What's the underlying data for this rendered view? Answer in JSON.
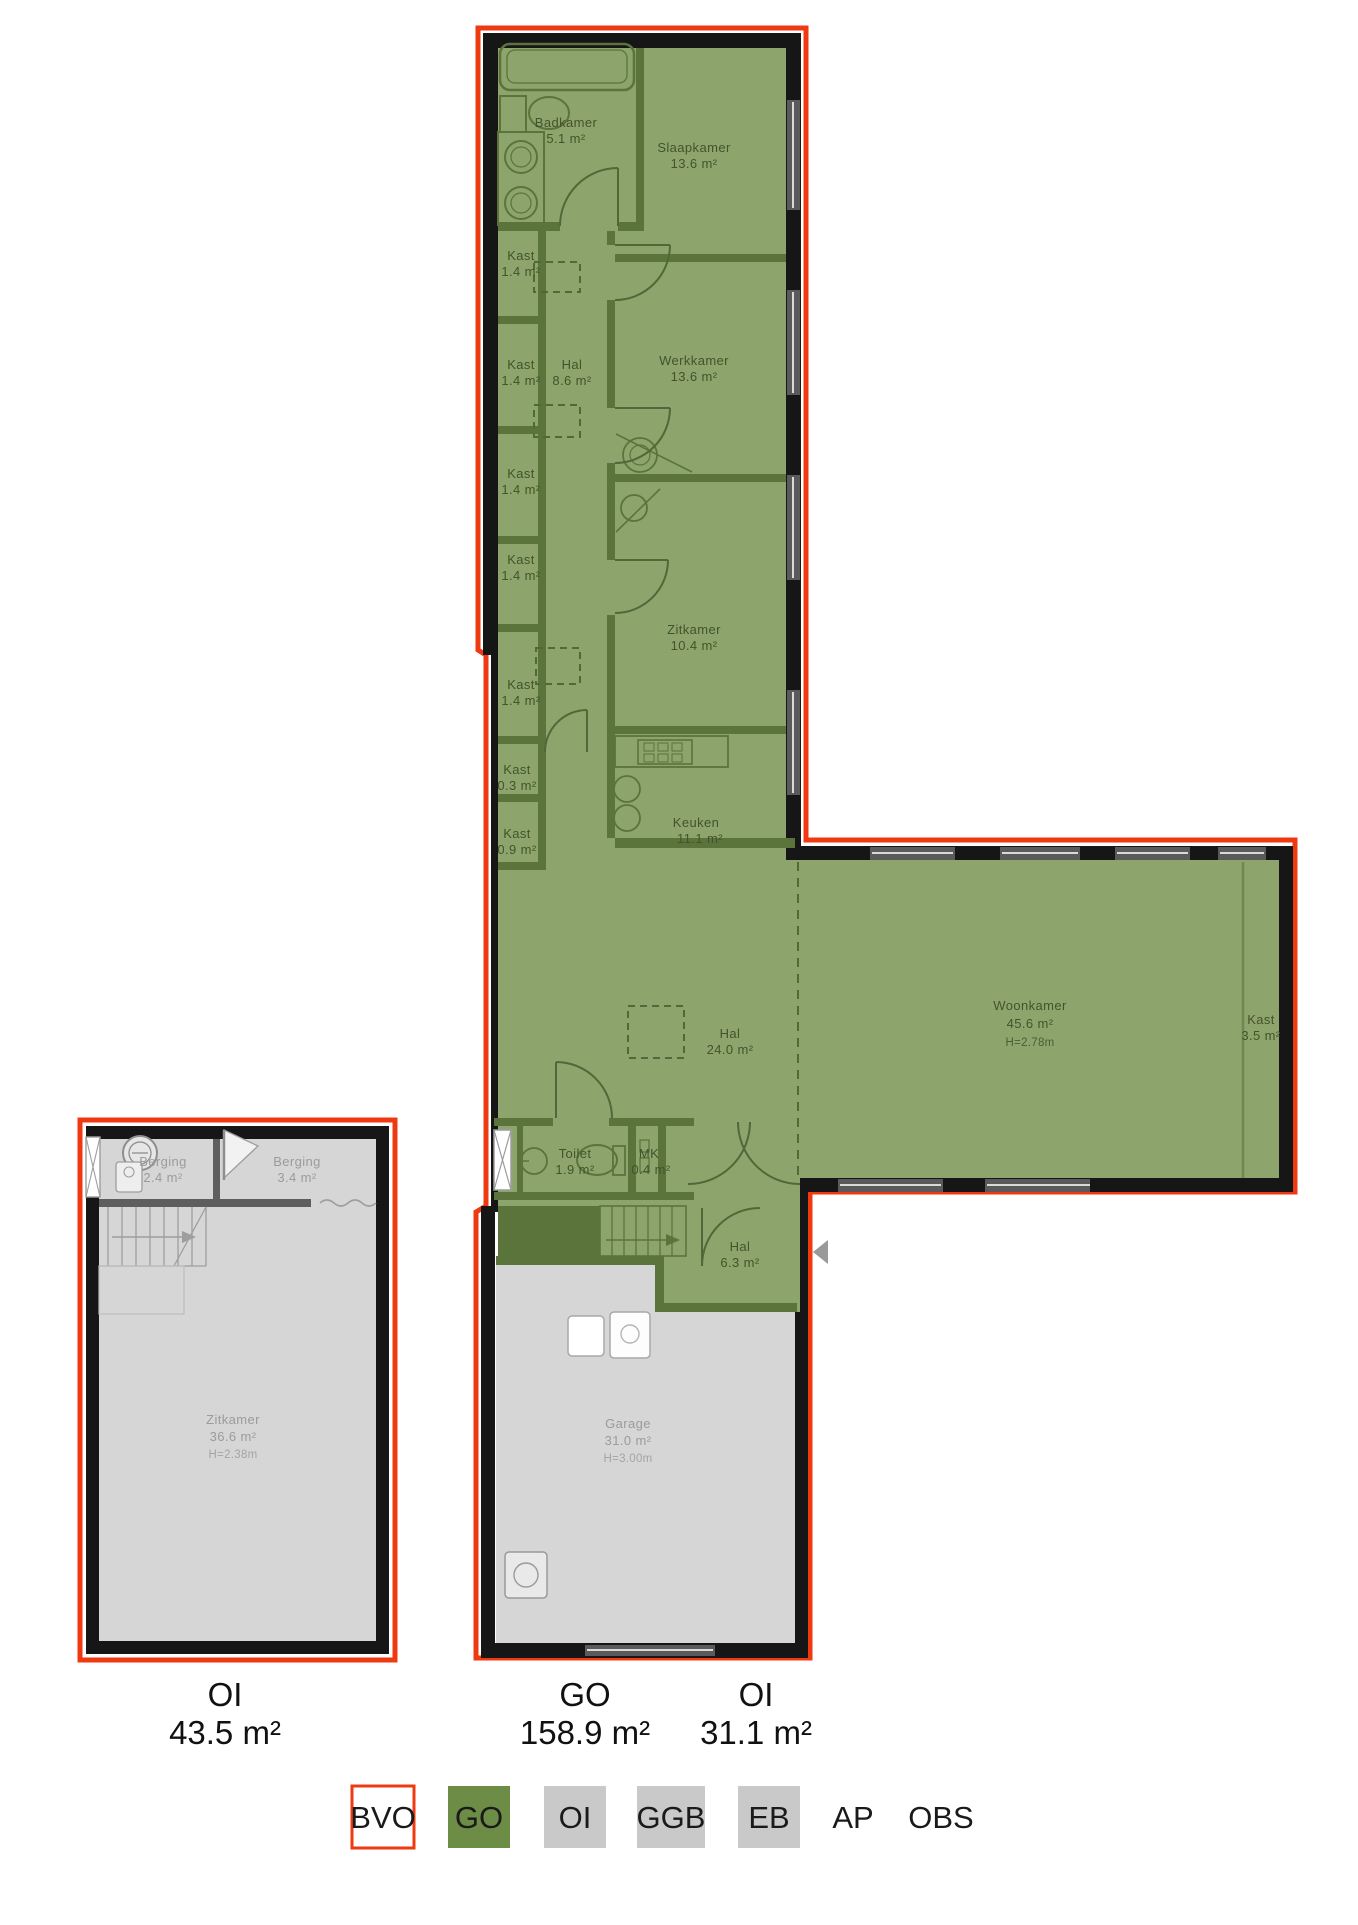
{
  "colors": {
    "bvo_outline": "#ef3a11",
    "go_fill": "#8ea46d",
    "go_wall": "#5b743c",
    "go_label": "#44532b",
    "oi_fill": "#d6d6d6",
    "oi_label": "#9b9b9b",
    "wall_black": "#161616",
    "legend_go": "#6d8c46",
    "legend_gray": "#c9c9c9",
    "window_gray": "#5a5a5a"
  },
  "plans": {
    "left": {
      "zone": "OI",
      "rooms": {
        "berging1": {
          "name": "Berging",
          "area": "2.4 m²"
        },
        "berging2": {
          "name": "Berging",
          "area": "3.4 m²"
        },
        "zitkamer": {
          "name": "Zitkamer",
          "area": "36.6 m²",
          "height": "H=2.38m"
        }
      }
    },
    "main": {
      "zone": "GO",
      "rooms": {
        "badkamer": {
          "name": "Badkamer",
          "area": "5.1 m²"
        },
        "slaapkamer": {
          "name": "Slaapkamer",
          "area": "13.6 m²"
        },
        "kast1": {
          "name": "Kast",
          "area": "1.4 m²"
        },
        "kast2": {
          "name": "Kast",
          "area": "1.4 m²"
        },
        "kast3": {
          "name": "Kast",
          "area": "1.4 m²"
        },
        "kast4": {
          "name": "Kast",
          "area": "1.4 m²"
        },
        "kast5": {
          "name": "Kast",
          "area": "1.4 m²"
        },
        "kast_03": {
          "name": "Kast",
          "area": "0.3 m²"
        },
        "kast_09": {
          "name": "Kast",
          "area": "0.9 m²"
        },
        "hal_boven": {
          "name": "Hal",
          "area": "8.6 m²"
        },
        "werkkamer": {
          "name": "Werkkamer",
          "area": "13.6 m²"
        },
        "zitkamer": {
          "name": "Zitkamer",
          "area": "10.4 m²"
        },
        "keuken": {
          "name": "Keuken",
          "area": "11.1 m²"
        },
        "hal_midden": {
          "name": "Hal",
          "area": "24.0 m²"
        },
        "woonkamer": {
          "name": "Woonkamer",
          "area": "45.6 m²",
          "height": "H=2.78m"
        },
        "kast_35": {
          "name": "Kast",
          "area": "3.5 m²"
        },
        "toilet": {
          "name": "Toilet",
          "area": "1.9 m²"
        },
        "mk": {
          "name": "MK",
          "area": "0.4 m²"
        },
        "hal_entree": {
          "name": "Hal",
          "area": "6.3 m²"
        },
        "garage": {
          "name": "Garage",
          "area": "31.0 m²",
          "height": "H=3.00m"
        }
      }
    }
  },
  "totals": [
    {
      "code": "OI",
      "area": "43.5 m²"
    },
    {
      "code": "GO",
      "area": "158.9 m²"
    },
    {
      "code": "OI",
      "area": "31.1 m²"
    }
  ],
  "legend": {
    "items": [
      {
        "label": "BVO",
        "swatch": "bvo"
      },
      {
        "label": "GO",
        "swatch": "go"
      },
      {
        "label": "OI",
        "swatch": "gray"
      },
      {
        "label": "GGB",
        "swatch": "gray"
      },
      {
        "label": "EB",
        "swatch": "gray"
      },
      {
        "label": "AP",
        "swatch": "none"
      },
      {
        "label": "OBS",
        "swatch": "none"
      }
    ]
  }
}
